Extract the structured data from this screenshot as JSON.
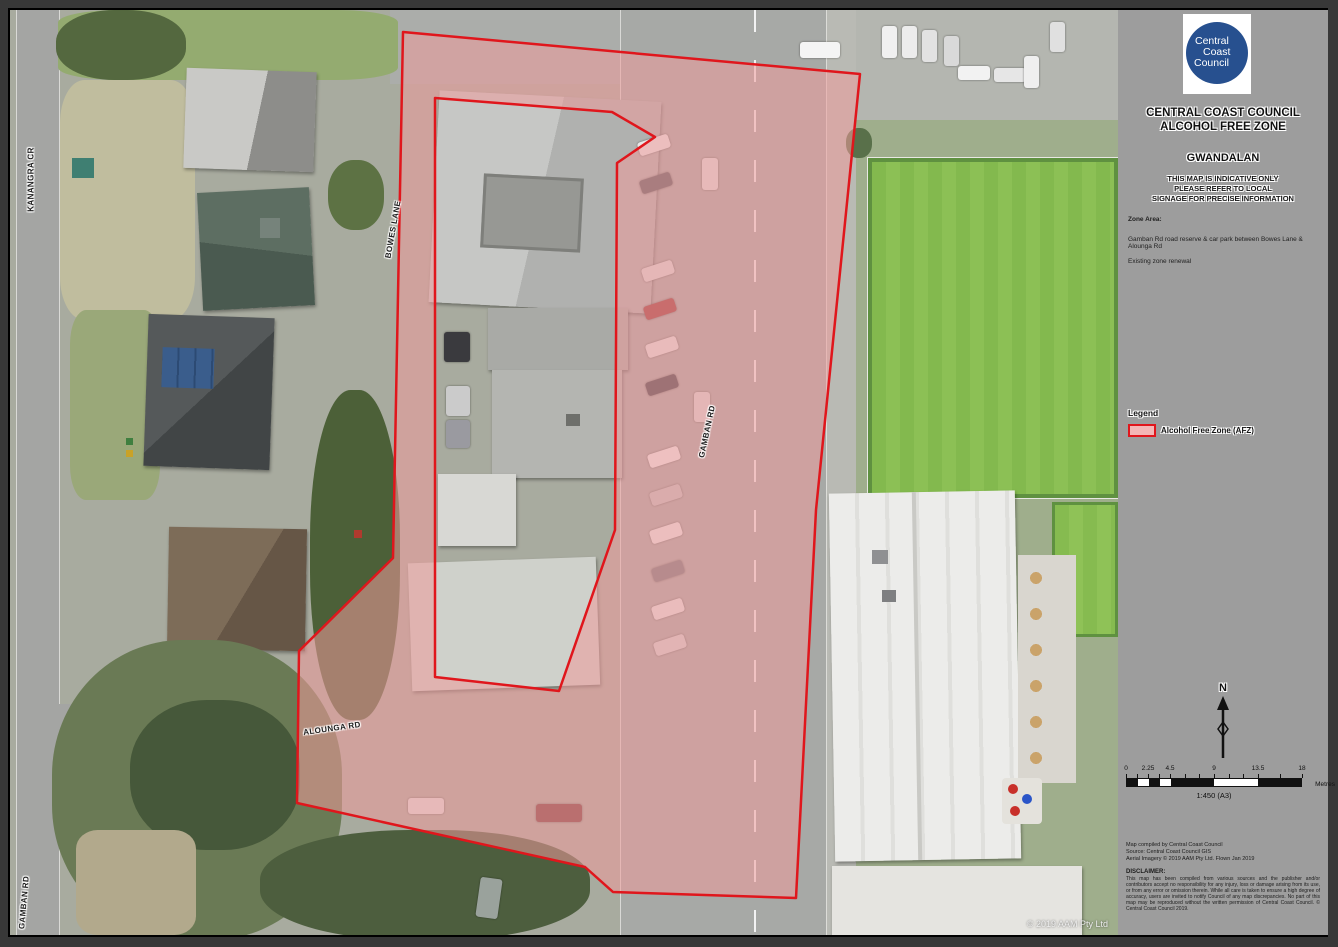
{
  "sidebar": {
    "logo_lines": [
      "Central",
      "Coast",
      "Council"
    ],
    "title_line1": "CENTRAL COAST COUNCIL",
    "title_line2": "ALCOHOL FREE ZONE",
    "location": "GWANDALAN",
    "note_lines": [
      "THIS MAP IS INDICATIVE ONLY",
      "PLEASE REFER TO LOCAL",
      "SIGNAGE FOR PRECISE INFORMATION"
    ],
    "zone_label": "Zone Area:",
    "zone_description": "Gamban Rd road reserve & car park between Bowes Lane & Alounga Rd",
    "zone_status": "Existing zone renewal",
    "legend_heading": "Legend",
    "legend_items": [
      {
        "label": "Alcohol Free Zone (AFZ)",
        "fill": "#f4b6b6",
        "border": "#e0161c"
      }
    ],
    "north_label": "N",
    "scale_bar": {
      "ticks": [
        "0",
        "2.25",
        "4.5",
        "9",
        "13.5",
        "18"
      ],
      "unit": "Metres",
      "scale_text": "1:450  (A3)"
    },
    "credits_lines": [
      "Map compiled by Central Coast Council",
      "Source: Central Coast Council GIS",
      "Aerial Imagery © 2019 AAM Pty Ltd. Flown Jan 2019"
    ],
    "disclaimer_heading": "DISCLAIMER:",
    "disclaimer_body": "This map has been compiled from various sources and the publisher and/or contributors accept no responsibility for any injury, loss or damage arising from its use, or from any error or omission therein. While all care is taken to ensure a high degree of accuracy, users are invited to notify Council of any map discrepancies. No part of this map may be reproduced without the written permission of Central Coast Council. © Central Coast Council 2019."
  },
  "map": {
    "street_labels": [
      {
        "text": "KANANGRA CR"
      },
      {
        "text": "BOWES LANE"
      },
      {
        "text": "GAMBAN RD"
      },
      {
        "text": "ALOUNGA RD"
      },
      {
        "text": "GAMBAN RD"
      }
    ],
    "copyright": "© 2019 AAM Pty Ltd"
  },
  "colors": {
    "zone_fill": "#efa0a0",
    "zone_border": "#e0161c",
    "logo_blue": "#27508f",
    "sidebar_grey": "#9d9d9d",
    "bowling_green": "#7fb84e"
  }
}
